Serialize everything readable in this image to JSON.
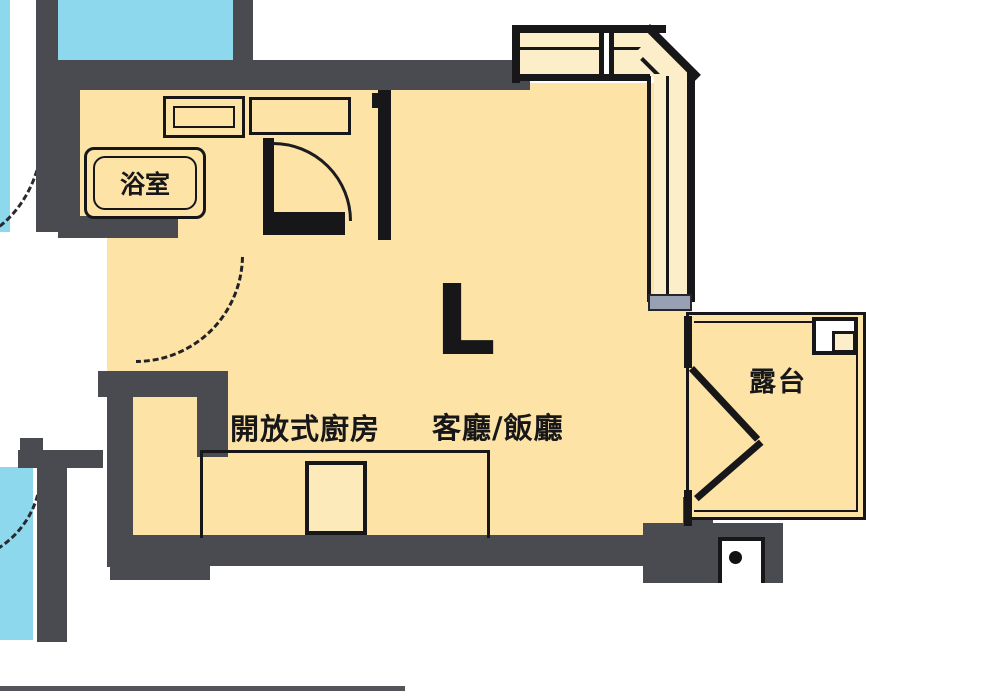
{
  "plan": {
    "type": "apartment-floor-plan",
    "unit_letter": "L"
  },
  "labels": {
    "unit": "L",
    "living_dining": "客廳/飯廳",
    "kitchen": "開放式廚房",
    "bathroom": "浴室",
    "balcony": "露台"
  },
  "colors": {
    "room_fill": "#fde3a6",
    "window_band_fill": "#fbeec8",
    "wall_gray": "#4a4a51",
    "line_black": "#17171a",
    "common_area_blue": "#8ed8ee",
    "window_sill_gray": "#98a1b3",
    "background": "#ffffff"
  }
}
